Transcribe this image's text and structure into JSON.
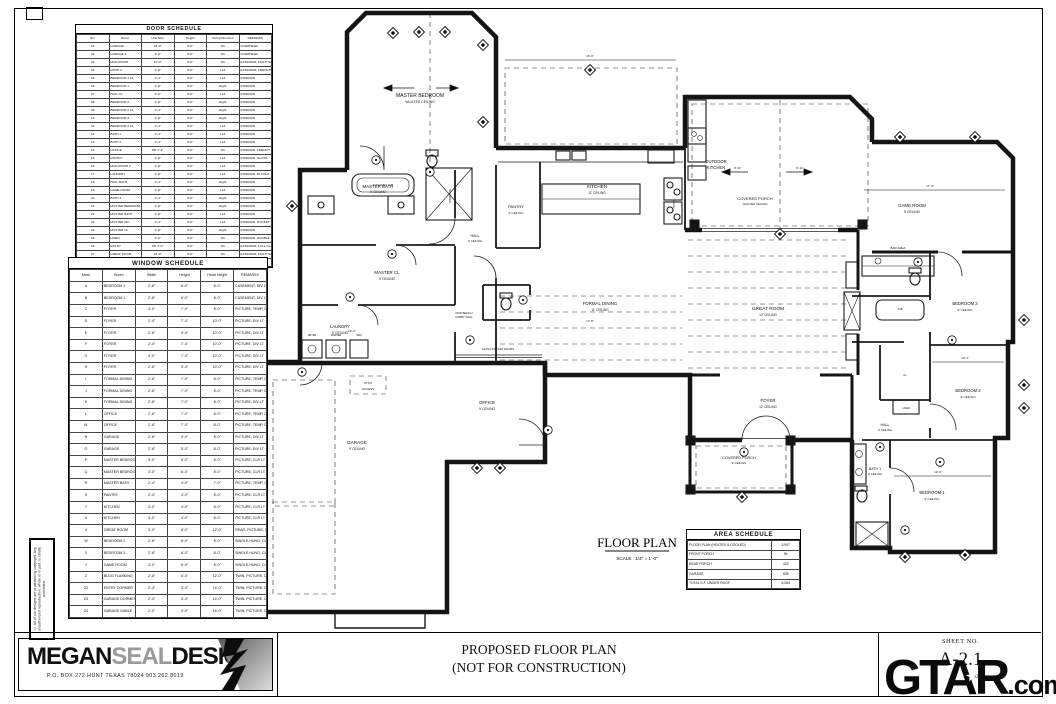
{
  "door_schedule": {
    "title": "DOOR SCHEDULE",
    "columns": [
      "NO.",
      "Room",
      "Unit Size",
      "Height",
      "Swing Direction",
      "REMARKS"
    ],
    "rows": [
      [
        "01",
        "GARAGE",
        "18'-0\"",
        "8'-0\"",
        "NA",
        "OVERHEAD"
      ],
      [
        "02",
        "GARAGE 2",
        "9'-0\"",
        "8'-0\"",
        "NA",
        "OVERHEAD"
      ],
      [
        "03",
        "MUD ROOM",
        "10'-0\"",
        "8'-0\"",
        "NA",
        "EXTERIOR, MULTI SLIDE GLASS"
      ],
      [
        "04",
        "PATIO 2",
        "2'-8\"",
        "8'-0\"",
        "Left",
        "EXTERIOR, FRENCH"
      ],
      [
        "05",
        "BEDROOM 1 CL",
        "2'-4\"",
        "8'-0\"",
        "Left",
        "INTERIOR"
      ],
      [
        "06",
        "BEDROOM 1",
        "2'-8\"",
        "8'-0\"",
        "Right",
        "INTERIOR"
      ],
      [
        "07",
        "HALL CL",
        "2'-0\"",
        "8'-0\"",
        "Left",
        "INTERIOR"
      ],
      [
        "08",
        "BEDROOM 2",
        "2'-8\"",
        "8'-0\"",
        "Right",
        "INTERIOR"
      ],
      [
        "09",
        "BEDROOM 2 CL",
        "2'-4\"",
        "8'-0\"",
        "Right",
        "INTERIOR"
      ],
      [
        "10",
        "BEDROOM 3",
        "2'-8\"",
        "8'-0\"",
        "Right",
        "INTERIOR"
      ],
      [
        "11",
        "BEDROOM 3 CL",
        "2'-4\"",
        "8'-0\"",
        "Left",
        "INTERIOR"
      ],
      [
        "12",
        "BATH 1",
        "2'-4\"",
        "8'-0\"",
        "Left",
        "INTERIOR"
      ],
      [
        "13",
        "BATH 2",
        "2'-4\"",
        "8'-0\"",
        "Left",
        "INTERIOR"
      ],
      [
        "14",
        "OFFICE",
        "PR 2'-4\"",
        "8'-0\"",
        "NA",
        "INTERIOR, FRENCH GLASS"
      ],
      [
        "15",
        "PANTRY",
        "2'-8\"",
        "8'-0\"",
        "Left",
        "INTERIOR, GLASS"
      ],
      [
        "16",
        "MUD ROOM 2",
        "2'-8\"",
        "8'-0\"",
        "Left",
        "INTERIOR"
      ],
      [
        "17",
        "LAUNDRY",
        "2'-8\"",
        "8'-0\"",
        "Left",
        "INTERIOR, BI-FOLD"
      ],
      [
        "18",
        "HALL BATH",
        "2'-4\"",
        "8'-0\"",
        "Right",
        "INTERIOR"
      ],
      [
        "19",
        "GAME ROOM",
        "2'-8\"",
        "8'-0\"",
        "Left",
        "INTERIOR"
      ],
      [
        "20",
        "BATH 3",
        "2'-4\"",
        "8'-0\"",
        "Right",
        "INTERIOR"
      ],
      [
        "21",
        "MASTER BEDROOM",
        "2'-8\"",
        "8'-0\"",
        "Right",
        "INTERIOR"
      ],
      [
        "22",
        "MASTER BATH",
        "2'-8\"",
        "8'-0\"",
        "Left",
        "INTERIOR"
      ],
      [
        "23",
        "MASTER WC",
        "2'-4\"",
        "8'-0\"",
        "Left",
        "INTERIOR, POCKET"
      ],
      [
        "24",
        "MASTER CL",
        "2'-8\"",
        "8'-0\"",
        "Right",
        "INTERIOR"
      ],
      [
        "25",
        "LINEN",
        "2'-0\"",
        "8'-0\"",
        "NA",
        "INTERIOR, DOUBLE"
      ],
      [
        "26",
        "ENTRY",
        "PR 3'-0\"",
        "8'-0\"",
        "NA",
        "EXTERIOR, FULL GLASS"
      ],
      [
        "27",
        "GREAT ROOM",
        "16'-0\"",
        "8'-0\"",
        "NA",
        "EXTERIOR, MULTI SLIDE GLASS"
      ],
      [
        "28",
        "POWDER",
        "2'-4\"",
        "8'-0\"",
        "Left",
        "INTERIOR"
      ]
    ]
  },
  "window_schedule": {
    "title": "WINDOW SCHEDULE",
    "columns": [
      "Mark",
      "Room",
      "Width",
      "Height",
      "Head Height",
      "REMARKS"
    ],
    "rows": [
      [
        "A",
        "BEDROOM 1",
        "2'-8\"",
        "6'-0\"",
        "8'-0\"",
        "CASEMENT, DIV LT"
      ],
      [
        "B",
        "BEDROOM 1",
        "2'-8\"",
        "6'-0\"",
        "8'-0\"",
        "CASEMENT, DIV LT"
      ],
      [
        "C",
        "FOYER",
        "3'-0\"",
        "7'-0\"",
        "8'-0\"",
        "PICTURE, TEMP, DIV LT"
      ],
      [
        "D",
        "FOYER",
        "2'-4\"",
        "7'-4\"",
        "10'-0\"",
        "PICTURE, DIV LT"
      ],
      [
        "E",
        "FOYER",
        "2'-8\"",
        "5'-4\"",
        "10'-0\"",
        "PICTURE, DIV LT"
      ],
      [
        "F",
        "FOYER",
        "2'-4\"",
        "7'-4\"",
        "10'-0\"",
        "PICTURE, DIV LT"
      ],
      [
        "G",
        "FOYER",
        "4'-0\"",
        "7'-4\"",
        "10'-0\"",
        "PICTURE, DIV LT"
      ],
      [
        "H",
        "FOYER",
        "2'-8\"",
        "5'-4\"",
        "10'-0\"",
        "PICTURE, DIV LT"
      ],
      [
        "I",
        "FORMAL DINING",
        "2'-8\"",
        "7'-0\"",
        "8'-0\"",
        "PICTURE, TEMP, DIV LT"
      ],
      [
        "J",
        "FORMAL DINING",
        "2'-8\"",
        "7'-0\"",
        "8'-0\"",
        "PICTURE, TEMP, DIV LT"
      ],
      [
        "K",
        "FORMAL DINING",
        "2'-8\"",
        "7'-0\"",
        "8'-0\"",
        "PICTURE, DIV LT"
      ],
      [
        "L",
        "OFFICE",
        "2'-8\"",
        "7'-0\"",
        "8'-0\"",
        "PICTURE, TEMP, DIV LT"
      ],
      [
        "M",
        "OFFICE",
        "2'-8\"",
        "7'-0\"",
        "8'-0\"",
        "PICTURE, TEMP, DIV LT"
      ],
      [
        "N",
        "GARAGE",
        "2'-8\"",
        "5'-0\"",
        "8'-0\"",
        "PICTURE, DIV LT"
      ],
      [
        "O",
        "GARAGE",
        "2'-8\"",
        "5'-0\"",
        "8'-0\"",
        "PICTURE, DIV LT"
      ],
      [
        "P",
        "MASTER BEDROOM",
        "3'-0\"",
        "6'-0\"",
        "8'-0\"",
        "PICTURE, CLR LT"
      ],
      [
        "Q",
        "MASTER BEDROOM",
        "3'-0\"",
        "6'-0\"",
        "8'-0\"",
        "PICTURE, CLR LT"
      ],
      [
        "R",
        "MASTER BATH",
        "2'-4\"",
        "4'-0\"",
        "7'-0\"",
        "PICTURE, TEMP, CLR LT"
      ],
      [
        "S",
        "PANTRY",
        "2'-4\"",
        "4'-0\"",
        "8'-0\"",
        "PICTURE, CLR LT"
      ],
      [
        "T",
        "KITCHEN",
        "3'-0\"",
        "4'-0\"",
        "8'-0\"",
        "PICTURE, CLR LT"
      ],
      [
        "U",
        "KITCHEN",
        "3'-0\"",
        "4'-0\"",
        "8'-0\"",
        "PICTURE, CLR LT"
      ],
      [
        "V",
        "GREAT ROOM",
        "3'-0\"",
        "8'-0\"",
        "12'-0\"",
        "REAR, PICTURE, CLR LT"
      ],
      [
        "W",
        "BEDROOM 2",
        "2'-8\"",
        "6'-0\"",
        "8'-0\"",
        "SINGLE HUNG, CLR LT"
      ],
      [
        "X",
        "BEDROOM 3",
        "2'-8\"",
        "6'-0\"",
        "8'-0\"",
        "SINGLE HUNG, CLR LT"
      ],
      [
        "Y",
        "GAME ROOM",
        "3'-0\"",
        "6'-0\"",
        "8'-0\"",
        "SINGLE HUNG, CLR LT"
      ],
      [
        "Z",
        "BLDG FLANKING",
        "2'-8\"",
        "5'-0\"",
        "12'-0\"",
        "TWIN, PICTURE, DIV LT"
      ],
      [
        "Z2",
        "ENTRY DORMER",
        "2'-4\"",
        "3'-4\"",
        "14'-0\"",
        "TWIN, PICTURE, DIV LT"
      ],
      [
        "Z3",
        "GARAGE DORMER",
        "2'-4\"",
        "3'-4\"",
        "14'-0\"",
        "TWIN, PICTURE, DIV LT"
      ],
      [
        "Z4",
        "GARAGE GABLE",
        "2'-0\"",
        "3'-0\"",
        "16'-0\"",
        "TWIN, PICTURE, DIV LT"
      ]
    ]
  },
  "area_schedule": {
    "title": "AREA SCHEDULE",
    "rows": [
      [
        "FLOOR PLAN (HEATED & COOLED)",
        "3,907"
      ],
      [
        "FRONT PORCH",
        "96"
      ],
      [
        "REAR PORCH",
        "423"
      ],
      [
        "GARAGE",
        "838"
      ],
      [
        "TOTAL S.F. UNDER ROOF",
        "5,264"
      ]
    ]
  },
  "plan": {
    "title": "FLOOR PLAN",
    "scale": "SCALE : 1/4\" = 1'-0\"",
    "rooms": {
      "master_bedroom": {
        "label": "MASTER BEDROOM",
        "note": "VAULTED CEILING"
      },
      "master_bath": {
        "label": "MASTER BATH",
        "note": "9' CEILING"
      },
      "master_closet": {
        "label": "MASTER CL",
        "note": "9' CEILING"
      },
      "laundry": {
        "label": "LAUNDRY",
        "note": "9' CEILING"
      },
      "pantry": {
        "label": "PANTRY",
        "note": "9' CEILING"
      },
      "hall": {
        "label": "HALL",
        "note": "9' CEILING"
      },
      "kitchen": {
        "label": "KITCHEN",
        "note": "11' CEILING"
      },
      "formal_dining": {
        "label": "FORMAL DINING",
        "note": "11' CEILING"
      },
      "great_room": {
        "label": "GREAT ROOM",
        "note": "12' CEILING"
      },
      "outdoor_kitchen": {
        "label": "OUTDOOR",
        "note": "KITCHEN"
      },
      "porch_rear": {
        "label": "COVERED PORCH",
        "note": "VAULTED CEILING"
      },
      "game_room": {
        "label": "GAME ROOM",
        "note": "9' CEILING"
      },
      "bar_area": {
        "label": "BAR AREA"
      },
      "bedroom3": {
        "label": "BEDROOM 3",
        "note": "9' CEILING"
      },
      "bedroom2": {
        "label": "BEDROOM 2",
        "note": "9' CEILING"
      },
      "bedroom1": {
        "label": "BEDROOM 1",
        "note": "9' CEILING"
      },
      "bath1": {
        "label": "BATH 1",
        "note": "9' CEILING"
      },
      "hall2": {
        "label": "HALL",
        "note": "9' CEILING"
      },
      "foyer": {
        "label": "FOYER",
        "note": "12' CEILING"
      },
      "porch_front": {
        "label": "COVERED PORCH",
        "note": "9' CEILING"
      },
      "office": {
        "label": "OFFICE",
        "note": "9' CEILING"
      },
      "garage": {
        "label": "GARAGE",
        "note": "9' CEILING"
      },
      "attic": {
        "label": "ATTIC",
        "note": "ACCESS"
      }
    },
    "fixtures": {
      "tub": "6' SOAKING TUB",
      "tub2": "TUB",
      "shower": "SHOWER",
      "range": "RANGE",
      "glass_pocket": "GLASS POCKET DOORS",
      "mud_bench": "MUD BENCH",
      "cubby": "CUBBY WALL",
      "linen": "LINEN",
      "dryer": "DRYER",
      "washer": "WASHER",
      "sink": "SINK",
      "cl": "CL"
    },
    "dims": {
      "game": "17'-4\"",
      "bed2": "13'-4\"",
      "bed1": "12'-0\"",
      "dining": "17'-8\"",
      "patio": "16'-0\"",
      "porch1": "8'-11\"",
      "porch2": "8'-11\"",
      "laundry": "13'-4\""
    }
  },
  "title_block": {
    "logo_megan": "MEGAN",
    "logo_seal": "SEAL",
    "logo_design": "DESIGN",
    "address": "P.O. BOX 272 HUNT TEXAS 78024 903.262.8019",
    "title_line1": "PROPOSED FLOOR PLAN",
    "title_line2": "(NOT FOR CONSTRUCTION)",
    "sheet_no_label": "SHEET NO.",
    "sheet_no": "A-2.1",
    "sheet_date": "2025"
  },
  "disclaimer": "© All of our designs are protected by copyright. Any unauthorized reproduction, whole or in part, is strictly prohibited.",
  "watermark": {
    "text_gtar": "GTAR",
    "text_com": ".com",
    "star": "★"
  }
}
